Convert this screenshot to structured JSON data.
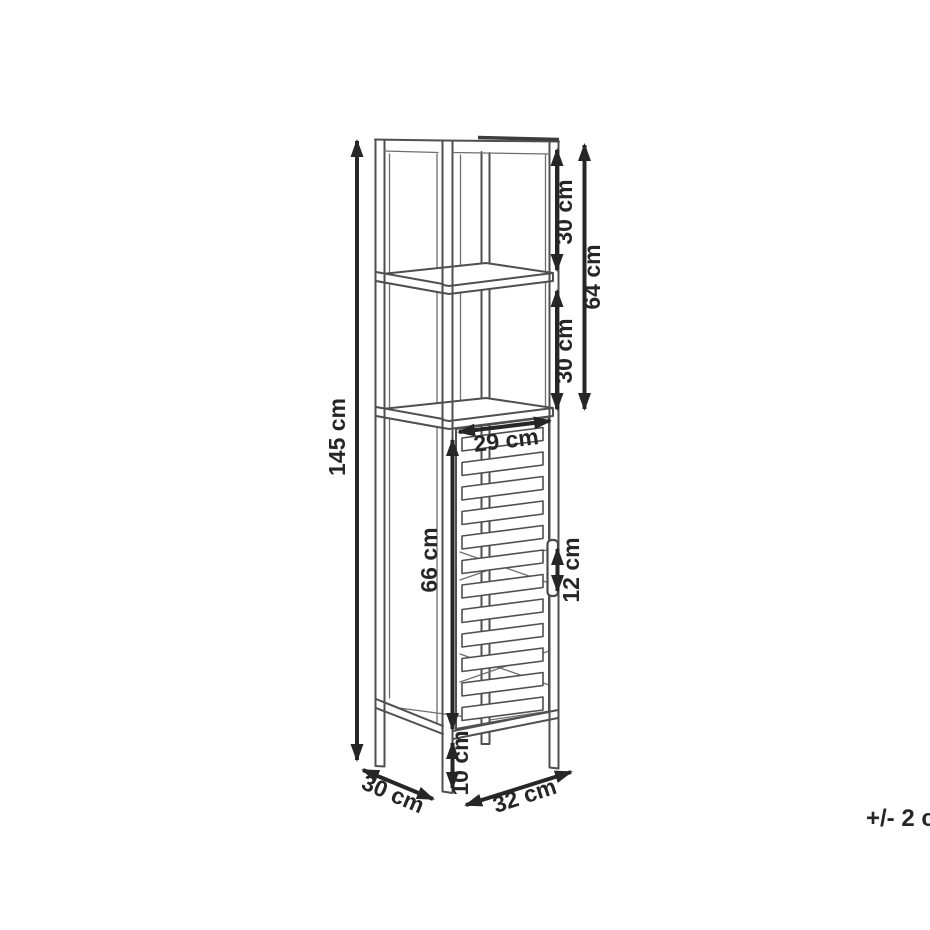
{
  "canvas": {
    "background": "#ffffff",
    "line_color": "#4f4f4f",
    "annotation_color": "#262626"
  },
  "drawing": {
    "subject": "tall slatted-door column cabinet with two open shelves on legs"
  },
  "annotations": {
    "total_height": "145 cm",
    "top_section_height": "30 cm",
    "upper_sections_height": "64 cm",
    "second_section_height": "30 cm",
    "door_width": "29 cm",
    "door_height": "66 cm",
    "handle_height": "12 cm",
    "leg_height": "10 cm",
    "depth": "30 cm",
    "width": "32 cm",
    "tolerance": "+/- 2 cm"
  }
}
